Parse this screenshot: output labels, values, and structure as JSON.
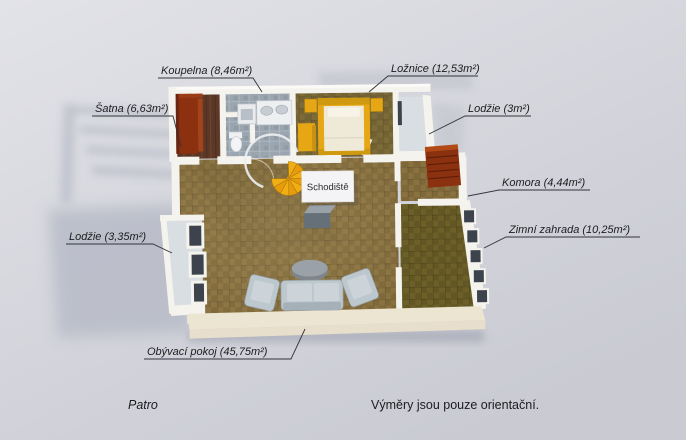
{
  "scene": {
    "floor_caption": "Patro",
    "note": "Výměry jsou pouze orientační."
  },
  "rooms": {
    "koupelna": "Koupelna (8,46m²)",
    "loznice": "Ložnice (12,53m²)",
    "satna": "Šatna (6,63m²)",
    "lodzie_top": "Lodžie (3m²)",
    "komora": "Komora (4,44m²)",
    "zimni_zahrada": "Zimní zahrada (10,25m²)",
    "lodzie_left": "Lodžie (3,35m²)",
    "obyvaci_pokoj": "Obývací pokoj (45,75m²)",
    "schodiste": "Schodiště"
  },
  "colors": {
    "background_top": "#e2e3e8",
    "background_bottom": "#c9cad2",
    "wall": "#f4f3ee",
    "wall_shade": "#d9d5c9",
    "wall_front": "#e7dfcb",
    "carpet": "#8a7240",
    "carpet_dark": "#6c6028",
    "bedroom_carpet": "#7d6b38",
    "tile": "#9aa5af",
    "wood": "#5e3826",
    "balcony_floor": "#d9dee2",
    "accent_yellow": "#e7a714",
    "maroon": "#8c3110",
    "sofa": "#bdc7ce",
    "glass": "#3c434c",
    "label_text": "#1c1c1e",
    "leader_line": "#33333a"
  }
}
